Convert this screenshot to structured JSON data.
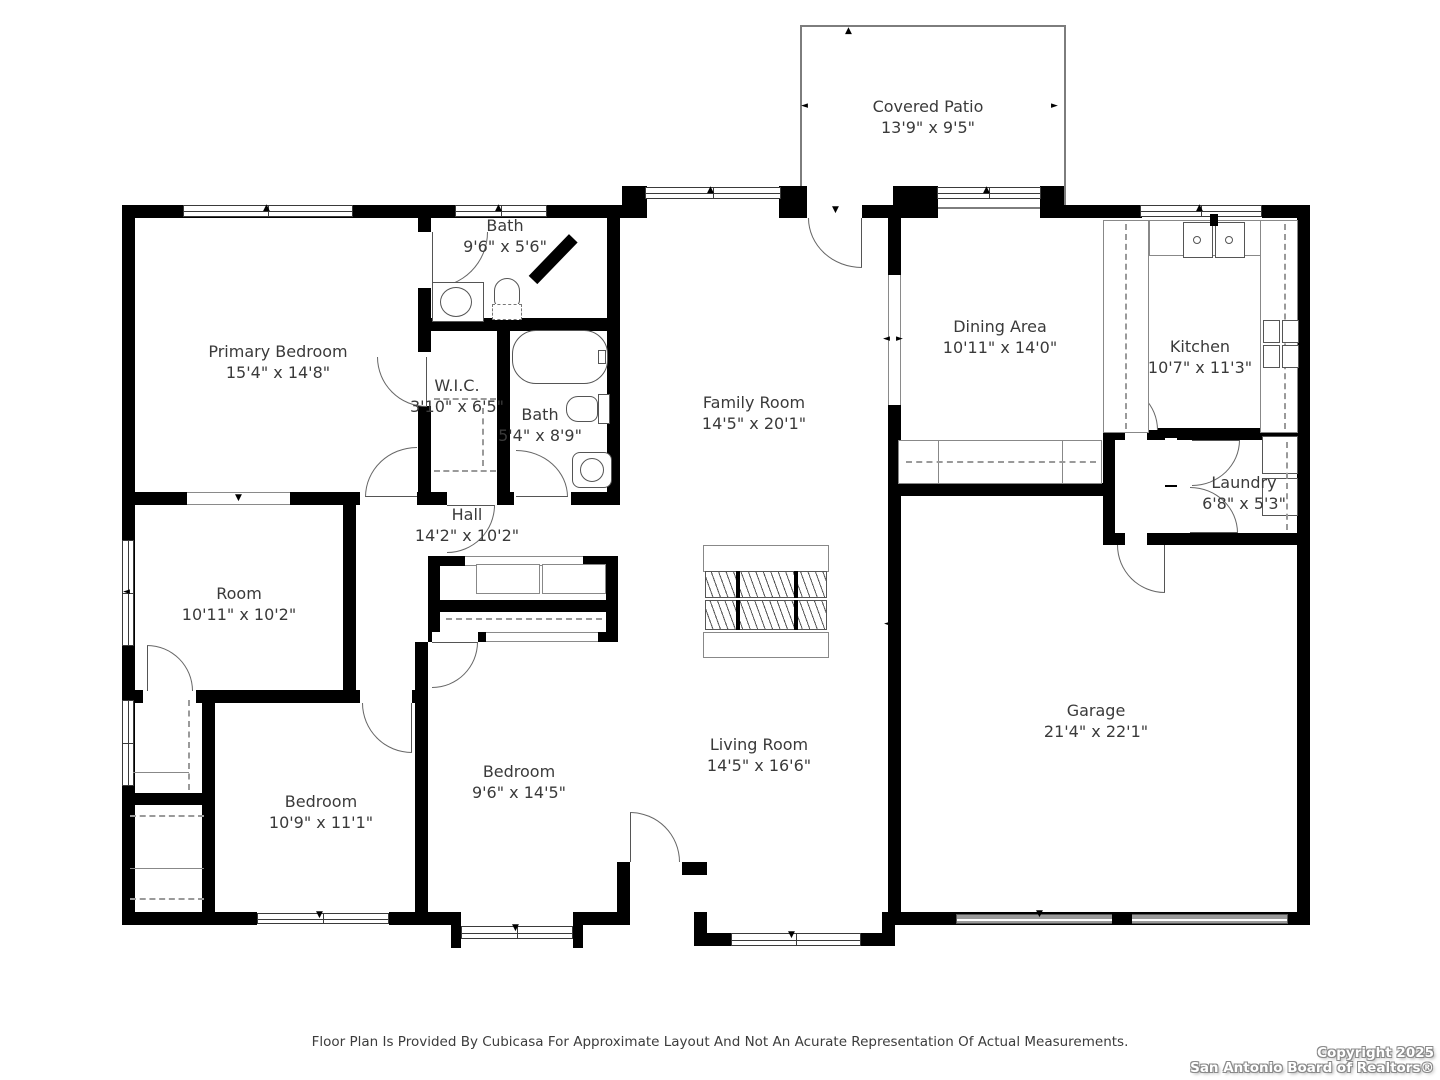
{
  "plan": {
    "rooms": [
      {
        "name": "Covered Patio",
        "dims": "13'9\" x 9'5\""
      },
      {
        "name": "Primary Bedroom",
        "dims": "15'4\" x 14'8\""
      },
      {
        "name": "Bath",
        "dims": "9'6\" x 5'6\""
      },
      {
        "name": "W.I.C.",
        "dims": "3'10\" x 6'5\""
      },
      {
        "name": "Bath",
        "dims": "5'4\" x 8'9\""
      },
      {
        "name": "Hall",
        "dims": "14'2\" x 10'2\""
      },
      {
        "name": "Family Room",
        "dims": "14'5\" x 20'1\""
      },
      {
        "name": "Dining Area",
        "dims": "10'11\" x 14'0\""
      },
      {
        "name": "Kitchen",
        "dims": "10'7\" x 11'3\""
      },
      {
        "name": "Laundry",
        "dims": "6'8\" x 5'3\""
      },
      {
        "name": "Room",
        "dims": "10'11\" x 10'2\""
      },
      {
        "name": "Bedroom",
        "dims": "10'9\" x 11'1\""
      },
      {
        "name": "Bedroom",
        "dims": "9'6\" x 14'5\""
      },
      {
        "name": "Living Room",
        "dims": "14'5\" x 16'6\""
      },
      {
        "name": "Garage",
        "dims": "21'4\" x 22'1\""
      }
    ],
    "footer": "Floor Plan Is Provided By Cubicasa For Approximate Layout And Not An Acurate Representation Of Actual Measurements.",
    "copyright_line1": "Copyright 2025",
    "copyright_line2": "San Antonio Board of Realtors®",
    "colors": {
      "wall": "#000000",
      "text": "#3a3a3a",
      "fixture_line": "#555555",
      "garage_door": "#9a9a9a"
    }
  }
}
